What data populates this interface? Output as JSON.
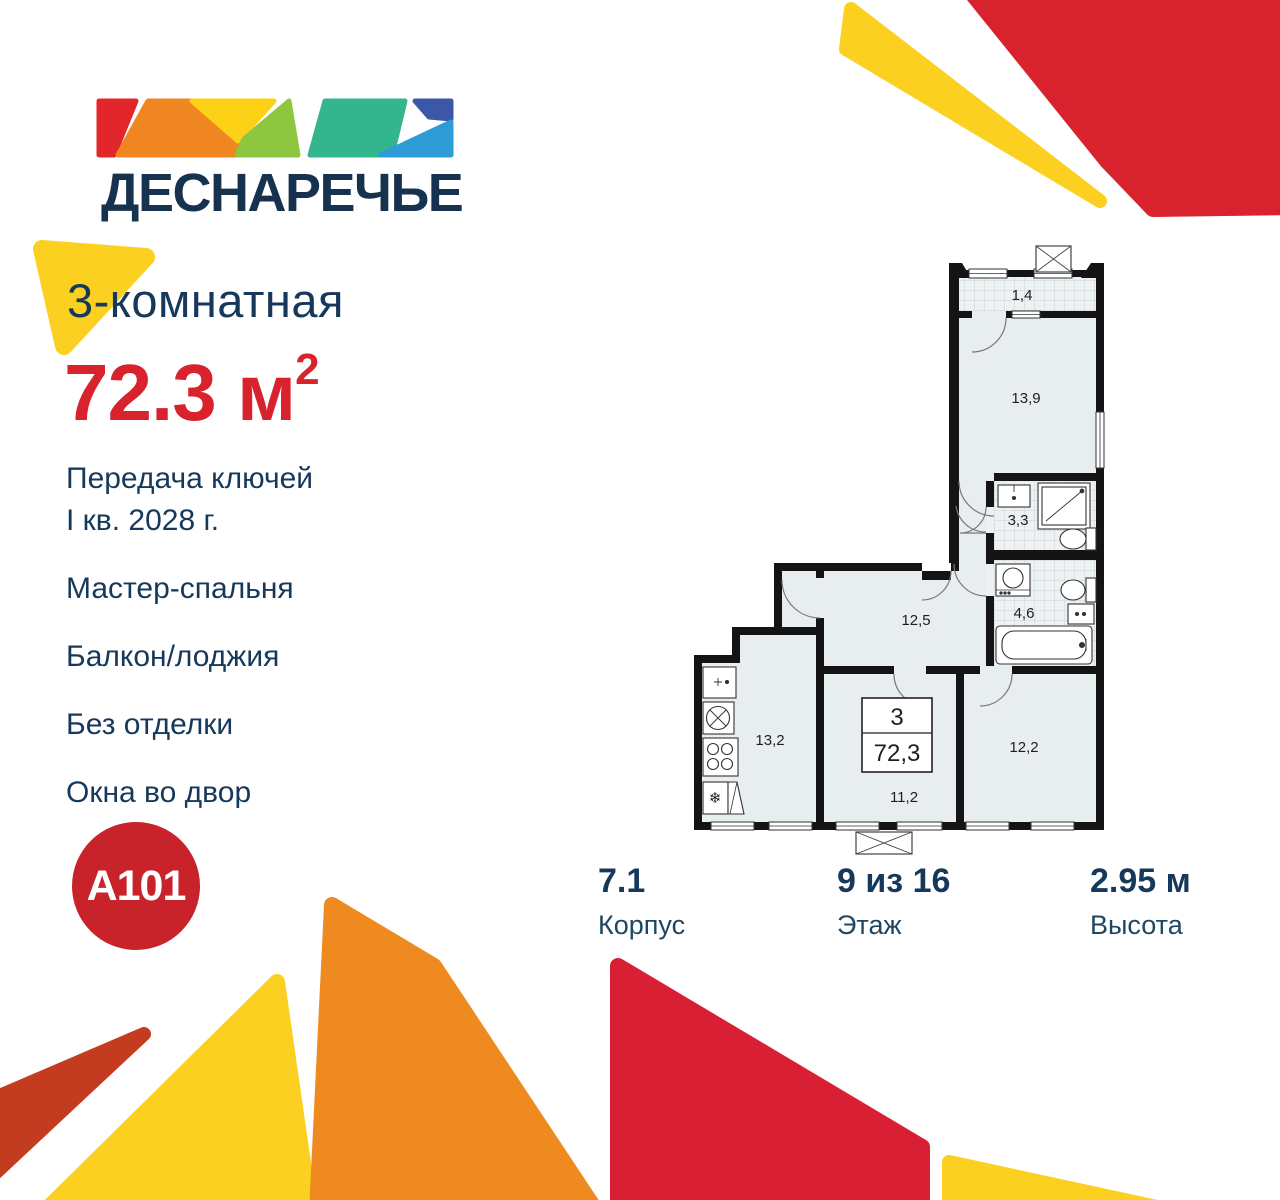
{
  "brand": {
    "name": "ДЕСНАРЕЧЬЕ",
    "developer": "A101"
  },
  "listing": {
    "type": "3-комнатная",
    "area_value": "72.3",
    "area_unit": "м",
    "area_power": "2",
    "features": [
      {
        "line1": "Передача ключей",
        "line2": "I кв. 2028 г."
      },
      {
        "line1": "Мастер-спальня"
      },
      {
        "line1": "Балкон/лоджия"
      },
      {
        "line1": "Без отделки"
      },
      {
        "line1": "Окна во двор"
      }
    ]
  },
  "stats": [
    {
      "value": "7.1",
      "label": "Корпус"
    },
    {
      "value": "9 из 16",
      "label": "Этаж"
    },
    {
      "value": "2.95 м",
      "label": "Высота"
    }
  ],
  "floorplan": {
    "info_box": {
      "rooms": "3",
      "area": "72,3"
    },
    "rooms": {
      "balcony": "1,4",
      "bedroom": "13,9",
      "bath_small": "3,3",
      "bath_large": "4,6",
      "hall": "12,5",
      "kitchen": "13,2",
      "room_center": "11,2",
      "room_right": "12,2"
    }
  },
  "colors": {
    "navy": "#16395B",
    "red": "#D8232E",
    "yellow": "#FBD020",
    "orange": "#EE8A20",
    "rust": "#C33C1F"
  }
}
